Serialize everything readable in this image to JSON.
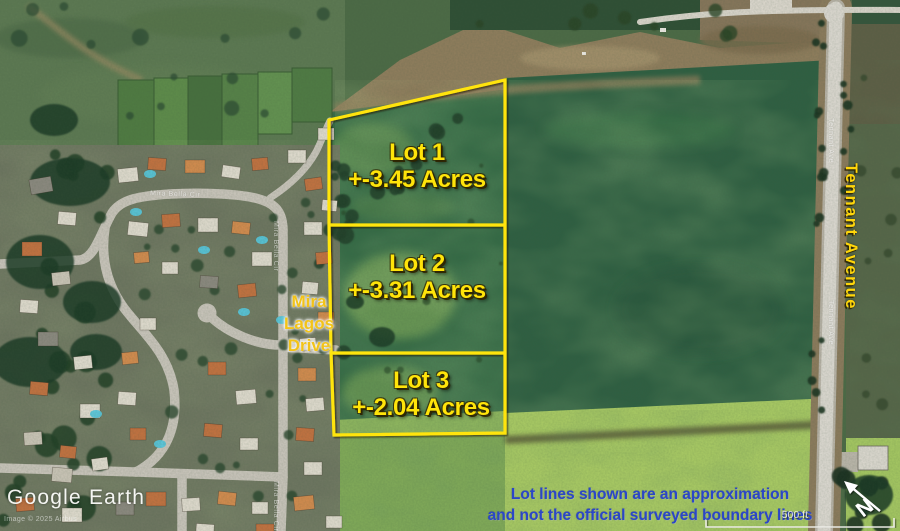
{
  "lots": [
    {
      "name": "Lot 1",
      "acres": "+-3.45 Acres"
    },
    {
      "name": "Lot 2",
      "acres": "+-3.31 Acres"
    },
    {
      "name": "Lot 3",
      "acres": "+-2.04 Acres"
    }
  ],
  "labels": {
    "mira_line1": "Mira",
    "mira_line2": "Lagos",
    "mira_line3": "Drive",
    "road": "Tennant Avenue",
    "street_top": "Mira Bella Cir",
    "street_side": "Mira Bella Cir",
    "street_bottom": "Mira Bella Cir",
    "road_small": "Tennant Ave"
  },
  "disclaimer": {
    "line1": "Lot lines shown are an approximation",
    "line2": "and not the official surveyed boundary lines"
  },
  "watermark": {
    "logo": "Google Earth",
    "credit": "Image © 2025 Airbus"
  },
  "scale_label": "500 ft",
  "compass_label": "N",
  "colors": {
    "lot_line": "#ffe40a",
    "lot_text": "#ffe40a",
    "street_label_yellow": "#f2c319",
    "road_label_yellow": "#ffd60a",
    "disclaimer_blue": "#2b47c7"
  }
}
